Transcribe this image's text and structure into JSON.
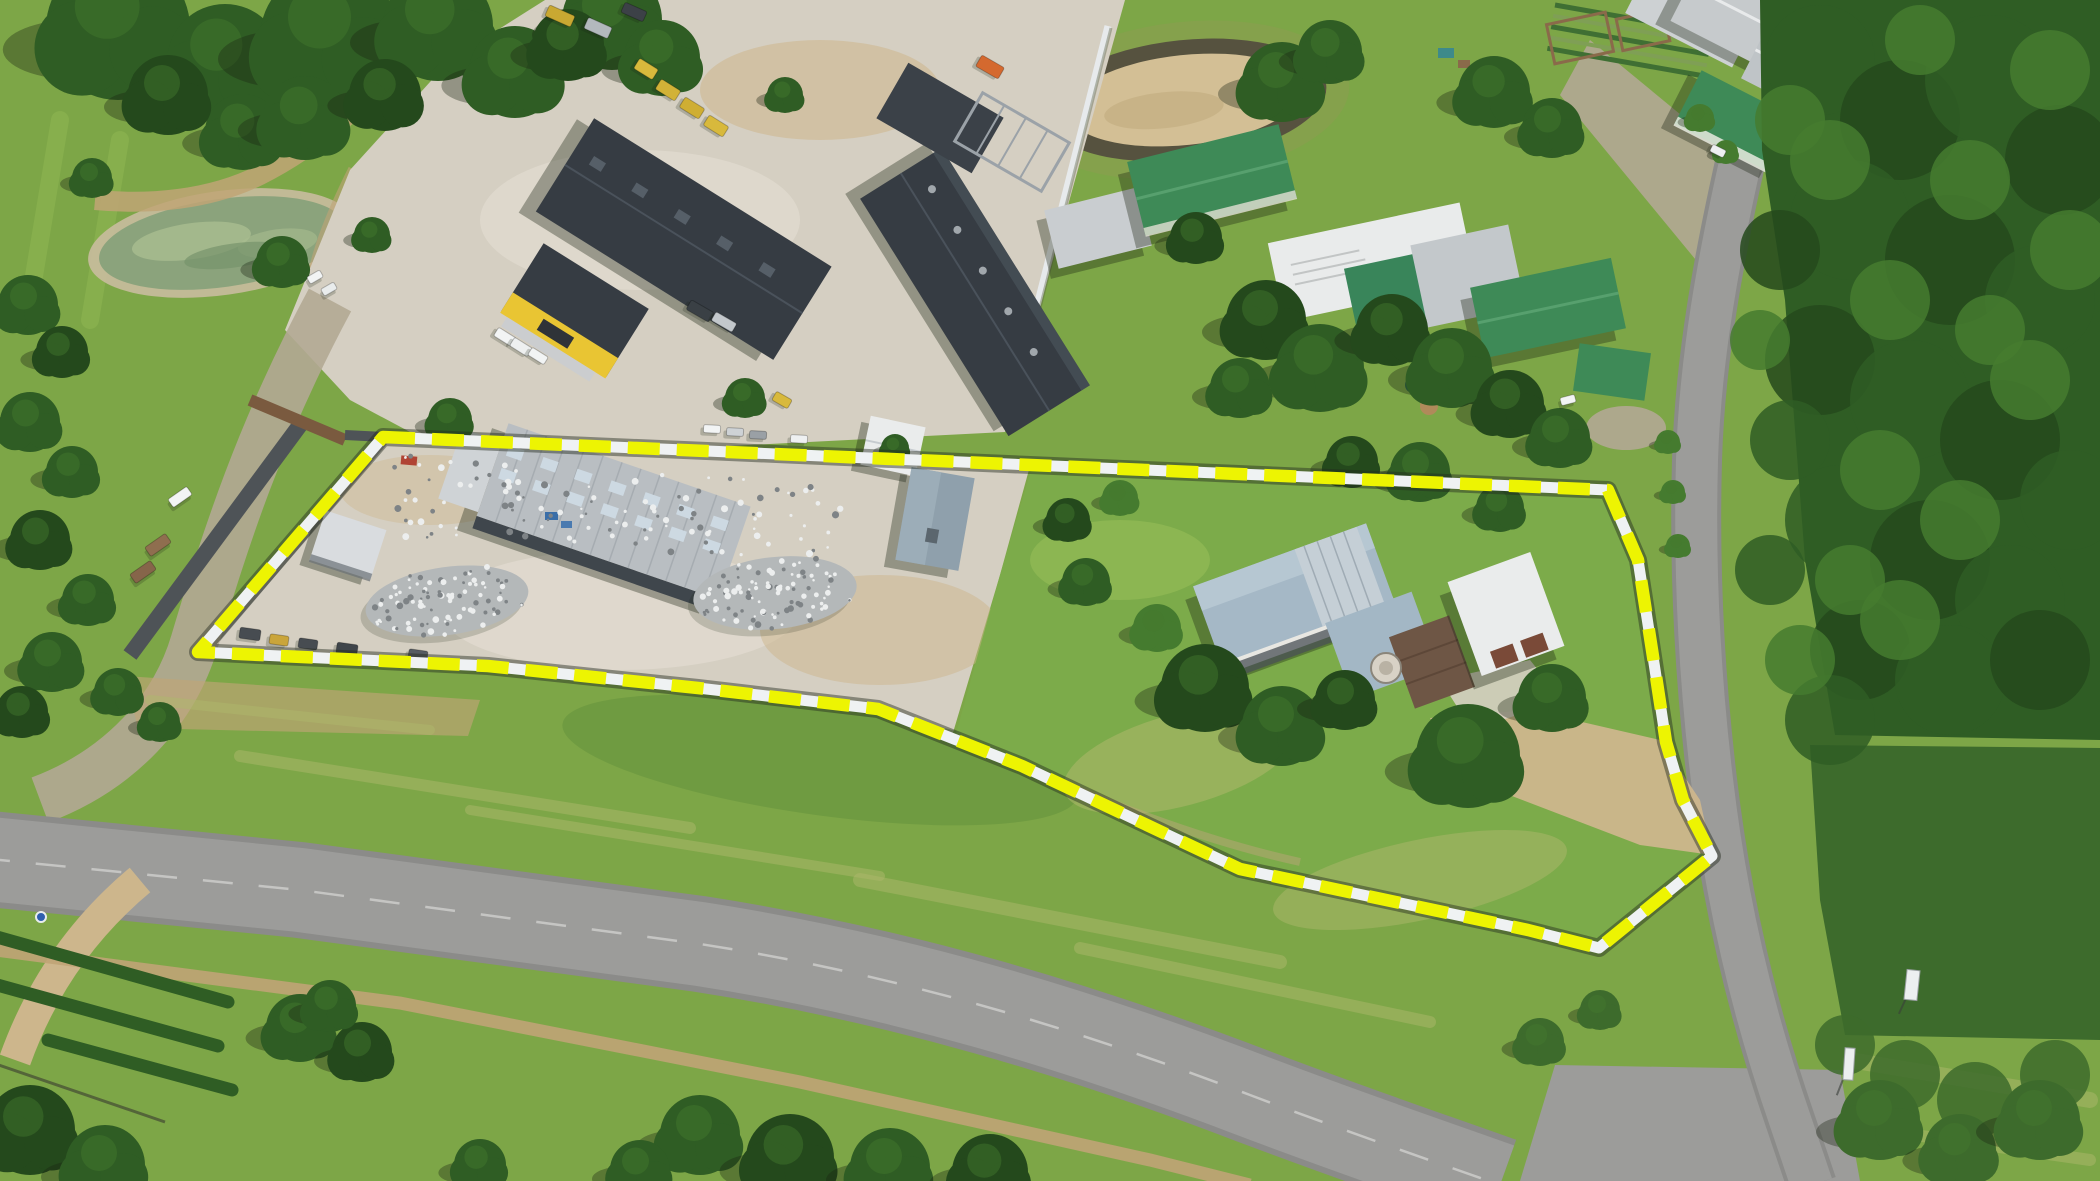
{
  "meta": {
    "description": "Aerial drone photograph of a rural industrial property for sale, outlined with a yellow dashed boundary line; scrap yard with warehouse and metal piles on the left, farmhouse with gardens on the right, neighbouring machinery yards, round sand dam, farm buildings, tar road junction below and dense natural bush on the right."
  },
  "colors": {
    "grass_base": "#7da647",
    "grass_light": "#9cc159",
    "grass_pale": "#aeb86b",
    "grass_dark": "#628f3b",
    "forest_dark": "#24491c",
    "forest": "#2f5d24",
    "forest_light": "#457b2f",
    "scrub": "#3d6b2c",
    "pond_algae": "#8ba37c",
    "pond_light": "#a9bd90",
    "sand_ring": "#c9bd9e",
    "dam_sand": "#d3bf95",
    "dam_rim": "#56523f",
    "dam_mound": "#85a14c",
    "concrete": "#d5cfc2",
    "concrete_light": "#e1dbd0",
    "dirt": "#c0a476",
    "dirt_light": "#cdb68c",
    "gravel": "#b2a894",
    "tar": "#9c9c9a",
    "tar_dark": "#8b8b89",
    "roof_dark": "#363c43",
    "roof_dark2": "#3b4148",
    "roof_silver": "#b9bec2",
    "roof_white": "#eaecec",
    "roof_blue": "#a5b8c6",
    "roof_green": "#3e8a57",
    "wall_white": "#e7eaec",
    "wall_dark": "#4e5357",
    "wall_brown": "#7a5a3f",
    "accent_yellow": "#e9c533",
    "logo_dark": "#2f3338",
    "boundary_yellow": "#edf402",
    "boundary_white": "#eff2f3",
    "boundary_shadow": "rgba(35,42,30,0.45)",
    "scrap_base": "#b4b8b9",
    "scrap_light": "#eceeee",
    "scrap_dark": "#7e8386",
    "vehicle_white": "#f2f4f4",
    "shadow": "rgba(25,35,18,0.35)"
  },
  "boundary": {
    "path": "M 383 437 L 1608 490 L 1638 560 L 1652 650 L 1666 742 L 1683 800 L 1712 856 L 1599 948 L 1528 930 L 1240 869 L 1022 766 L 878 709 L 698 688 L 488 666 L 198 652 Z",
    "dash": "32 17"
  },
  "trees": [
    [
      118,
      28,
      72,
      1
    ],
    [
      225,
      62,
      58,
      1
    ],
    [
      330,
      38,
      70,
      1
    ],
    [
      438,
      26,
      55,
      1
    ],
    [
      515,
      72,
      46,
      1
    ],
    [
      612,
      20,
      50,
      1
    ],
    [
      662,
      58,
      38,
      1
    ],
    [
      243,
      132,
      38,
      1
    ],
    [
      305,
      118,
      42,
      1
    ],
    [
      168,
      95,
      40,
      0
    ],
    [
      385,
      95,
      36,
      0
    ],
    [
      568,
      45,
      36,
      0
    ],
    [
      282,
      262,
      26,
      1
    ],
    [
      450,
      420,
      22,
      1
    ],
    [
      372,
      235,
      18,
      1
    ],
    [
      92,
      178,
      20,
      1
    ],
    [
      745,
      398,
      20,
      1
    ],
    [
      785,
      95,
      18,
      1
    ],
    [
      28,
      305,
      30,
      1
    ],
    [
      62,
      352,
      26,
      0
    ],
    [
      30,
      422,
      30,
      1
    ],
    [
      72,
      472,
      26,
      1
    ],
    [
      40,
      540,
      30,
      0
    ],
    [
      88,
      600,
      26,
      1
    ],
    [
      52,
      662,
      30,
      1
    ],
    [
      118,
      692,
      24,
      1
    ],
    [
      22,
      712,
      26,
      0
    ],
    [
      160,
      722,
      20,
      1
    ],
    [
      1282,
      82,
      40,
      1
    ],
    [
      1330,
      52,
      32,
      1
    ],
    [
      1494,
      92,
      36,
      1
    ],
    [
      1552,
      128,
      30,
      1
    ],
    [
      1196,
      238,
      26,
      0
    ],
    [
      1266,
      320,
      40,
      0
    ],
    [
      1320,
      368,
      44,
      1
    ],
    [
      1392,
      330,
      36,
      0
    ],
    [
      1452,
      368,
      40,
      1
    ],
    [
      1510,
      404,
      34,
      0
    ],
    [
      1560,
      438,
      30,
      1
    ],
    [
      1240,
      388,
      30,
      1
    ],
    [
      1068,
      520,
      22,
      0
    ],
    [
      1120,
      498,
      18,
      2
    ],
    [
      1086,
      582,
      24,
      1
    ],
    [
      1205,
      688,
      44,
      0
    ],
    [
      1282,
      726,
      40,
      1
    ],
    [
      1345,
      700,
      30,
      0
    ],
    [
      1468,
      756,
      52,
      1
    ],
    [
      1552,
      698,
      34,
      1
    ],
    [
      1420,
      472,
      30,
      1
    ],
    [
      1352,
      462,
      26,
      0
    ],
    [
      1500,
      508,
      24,
      1
    ],
    [
      895,
      448,
      14,
      1
    ],
    [
      1157,
      628,
      24,
      2
    ],
    [
      300,
      1028,
      34,
      1
    ],
    [
      362,
      1052,
      30,
      0
    ],
    [
      330,
      1006,
      26,
      1
    ],
    [
      700,
      1135,
      40,
      1
    ],
    [
      790,
      1158,
      44,
      0
    ],
    [
      890,
      1168,
      40,
      1
    ],
    [
      990,
      1172,
      38,
      0
    ],
    [
      640,
      1170,
      30,
      1
    ],
    [
      480,
      1165,
      26,
      1
    ],
    [
      30,
      1130,
      45,
      0
    ],
    [
      105,
      1165,
      40,
      1
    ],
    [
      1880,
      1120,
      40,
      3
    ],
    [
      1960,
      1150,
      36,
      3
    ],
    [
      2040,
      1120,
      40,
      3
    ],
    [
      1540,
      1042,
      24,
      3
    ],
    [
      1600,
      1010,
      20,
      3
    ],
    [
      1668,
      442,
      12,
      2
    ],
    [
      1673,
      492,
      12,
      2
    ],
    [
      1678,
      546,
      12,
      2
    ],
    [
      1700,
      118,
      14,
      2
    ],
    [
      1726,
      152,
      12,
      2
    ]
  ],
  "canopy": [
    [
      1820,
      60,
      55,
      1
    ],
    [
      1900,
      120,
      60,
      0
    ],
    [
      1990,
      80,
      65,
      1
    ],
    [
      2060,
      160,
      55,
      0
    ],
    [
      1850,
      220,
      60,
      1
    ],
    [
      1950,
      260,
      65,
      0
    ],
    [
      2040,
      300,
      55,
      1
    ],
    [
      1820,
      360,
      55,
      0
    ],
    [
      1910,
      400,
      60,
      1
    ],
    [
      2000,
      440,
      60,
      0
    ],
    [
      2070,
      500,
      50,
      1
    ],
    [
      1840,
      520,
      55,
      1
    ],
    [
      1930,
      560,
      60,
      0
    ],
    [
      2010,
      600,
      55,
      1
    ],
    [
      1860,
      650,
      50,
      0
    ],
    [
      1950,
      680,
      55,
      1
    ],
    [
      2040,
      660,
      50,
      0
    ],
    [
      1830,
      720,
      45,
      1
    ],
    [
      1790,
      440,
      40,
      1
    ],
    [
      1780,
      250,
      40,
      0
    ],
    [
      1770,
      570,
      35,
      1
    ],
    [
      1890,
      300,
      40,
      2
    ],
    [
      1970,
      180,
      40,
      2
    ],
    [
      2030,
      380,
      40,
      2
    ],
    [
      1880,
      470,
      40,
      2
    ],
    [
      1960,
      520,
      40,
      2
    ],
    [
      1830,
      160,
      40,
      2
    ],
    [
      2070,
      250,
      40,
      2
    ],
    [
      1900,
      620,
      40,
      2
    ],
    [
      1790,
      120,
      35,
      2
    ],
    [
      1850,
      580,
      35,
      2
    ],
    [
      2050,
      70,
      40,
      2
    ],
    [
      1920,
      40,
      35,
      2
    ],
    [
      1990,
      330,
      35,
      2
    ],
    [
      1760,
      340,
      30,
      2
    ],
    [
      1800,
      660,
      35,
      2
    ],
    [
      1905,
      1075,
      35,
      3
    ],
    [
      1975,
      1100,
      38,
      3
    ],
    [
      2055,
      1075,
      35,
      3
    ],
    [
      1845,
      1045,
      30,
      3
    ]
  ],
  "scrap": {
    "piles": [
      {
        "cx": 447,
        "cy": 601,
        "rx": 82,
        "ry": 34,
        "rot": -8,
        "n": 95,
        "seed": 3
      },
      {
        "cx": 775,
        "cy": 593,
        "rx": 82,
        "ry": 36,
        "rot": -6,
        "n": 95,
        "seed": 11
      }
    ],
    "band": {
      "x": 395,
      "y": 452,
      "w": 450,
      "h": 84,
      "rot": 4,
      "n": 120,
      "seed": 29
    }
  },
  "vehicles": [
    [
      315,
      277,
      15,
      8,
      -30,
      "#f2f4f4"
    ],
    [
      329,
      289,
      15,
      8,
      -30,
      "#e9ecec"
    ],
    [
      505,
      337,
      21,
      10,
      32,
      "#f2f4f4"
    ],
    [
      521,
      347,
      21,
      10,
      32,
      "#eef0f0"
    ],
    [
      538,
      356,
      19,
      9,
      32,
      "#f2f4f4"
    ],
    [
      700,
      311,
      26,
      11,
      30,
      "#3a4045"
    ],
    [
      724,
      322,
      24,
      10,
      30,
      "#c3c8cc"
    ],
    [
      646,
      69,
      22,
      12,
      32,
      "#d8b93c"
    ],
    [
      668,
      90,
      23,
      12,
      32,
      "#d2b237"
    ],
    [
      692,
      108,
      23,
      12,
      32,
      "#cfae33"
    ],
    [
      716,
      126,
      23,
      12,
      32,
      "#d8b93c"
    ],
    [
      560,
      16,
      28,
      12,
      24,
      "#c9a832"
    ],
    [
      598,
      28,
      26,
      12,
      24,
      "#b3b9bd"
    ],
    [
      634,
      12,
      24,
      11,
      24,
      "#3c4147"
    ],
    [
      990,
      67,
      26,
      13,
      30,
      "#d4692f"
    ],
    [
      712,
      429,
      17,
      8,
      3,
      "#f2f4f4"
    ],
    [
      735,
      432,
      17,
      8,
      3,
      "#ced2d5"
    ],
    [
      758,
      435,
      17,
      8,
      3,
      "#9aa0a5"
    ],
    [
      799,
      439,
      17,
      8,
      3,
      "#eef0f1"
    ],
    [
      250,
      634,
      21,
      11,
      8,
      "#474c51"
    ],
    [
      279,
      640,
      19,
      10,
      8,
      "#caa53a"
    ],
    [
      308,
      644,
      19,
      10,
      8,
      "#474c51"
    ],
    [
      347,
      649,
      21,
      11,
      8,
      "#3f454a"
    ],
    [
      418,
      655,
      19,
      10,
      8,
      "#565c62"
    ],
    [
      180,
      497,
      23,
      10,
      -35,
      "#f2f4f4"
    ],
    [
      158,
      545,
      25,
      11,
      -35,
      "#8f6e4f"
    ],
    [
      143,
      572,
      25,
      11,
      -35,
      "#86654a"
    ],
    [
      782,
      400,
      18,
      10,
      30,
      "#d8b93c"
    ],
    [
      1568,
      400,
      15,
      8,
      -15,
      "#f2f4f4"
    ],
    [
      1718,
      151,
      15,
      8,
      27,
      "#eef0f1"
    ]
  ],
  "signs": [
    {
      "x": 1912,
      "y": 985,
      "w": 13,
      "h": 30,
      "rot": 6
    },
    {
      "x": 1849,
      "y": 1064,
      "w": 10,
      "h": 32,
      "rot": 4
    }
  ]
}
